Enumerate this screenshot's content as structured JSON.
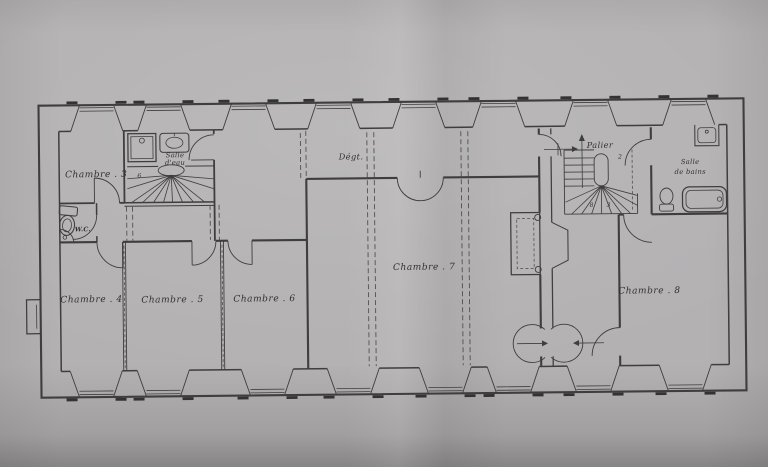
{
  "photo": {
    "paper_color": "#b3b1b2",
    "ink_color": "#3f3e3f",
    "shadow_edge_color": "#868485"
  },
  "plan": {
    "rooms": {
      "chambre3": {
        "label": "Chambre . 3"
      },
      "chambre4": {
        "label": "Chambre . 4"
      },
      "chambre5": {
        "label": "Chambre . 5"
      },
      "chambre6": {
        "label": "Chambre . 6"
      },
      "chambre7": {
        "label": "Chambre . 7"
      },
      "chambre8": {
        "label": "Chambre . 8"
      },
      "wc": {
        "label": "W.C."
      },
      "degagement": {
        "label": "Dégt."
      },
      "palier": {
        "label": "Palier"
      },
      "salle_eau": {
        "lines": [
          "Salle",
          "d'eau"
        ]
      },
      "salle_bains": {
        "lines": [
          "Salle",
          "de bains"
        ]
      }
    },
    "stair_numbers": {
      "left_stair": "6",
      "palier_top": "2",
      "palier_a": "8",
      "palier_b": "3"
    }
  }
}
